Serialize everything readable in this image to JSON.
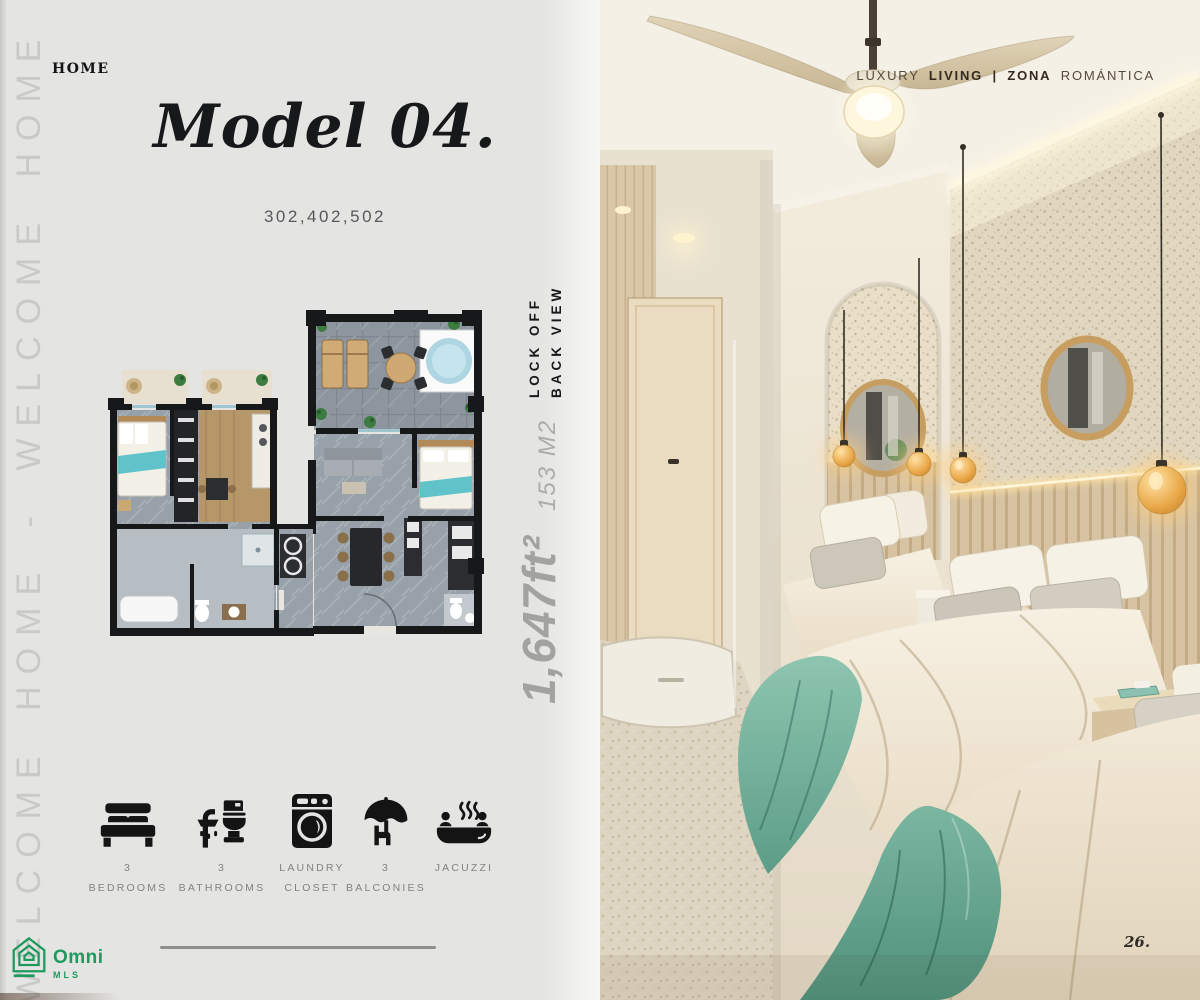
{
  "header": {
    "eyebrow": "HOME",
    "title": "Model 04.",
    "units": "302,402,502"
  },
  "edge_text": "WELCOME HOME - WELCOME HOME",
  "plan": {
    "lock_off": "LOCK OFF",
    "back_view": "BACK VIEW",
    "area_sqft": "1,647ft²",
    "area_m2": "153 M2"
  },
  "features": [
    {
      "icon": "bed-icon",
      "line1": "3",
      "line2": "BEDROOMS"
    },
    {
      "icon": "bathroom-icon",
      "line1": "3",
      "line2": "BATHROOMS"
    },
    {
      "icon": "laundry-icon",
      "line1": "LAUNDRY",
      "line2": "CLOSET"
    },
    {
      "icon": "balcony-icon",
      "line1": "3",
      "line2": "BALCONIES"
    },
    {
      "icon": "jacuzzi-icon",
      "line1": "JACUZZI",
      "line2": ""
    }
  ],
  "logo": {
    "brand": "Omni",
    "sub": "MLS"
  },
  "photo": {
    "caption": {
      "light1": "LUXURY",
      "bold1": "LIVING",
      "sep": "|",
      "bold2": "ZONA",
      "light2": "ROMÁNTICA"
    },
    "page_number": "26."
  },
  "colors": {
    "panel_bg": "#e4e4e2",
    "ink": "#17181a",
    "muted_label": "#828280",
    "edge_text": "#c9c9c7",
    "logo_green": "#1f9a5f",
    "throw_teal": "#74b29e",
    "accent_wood": "#d5c2a2",
    "jacuzzi_blue": "#aed5e2"
  }
}
